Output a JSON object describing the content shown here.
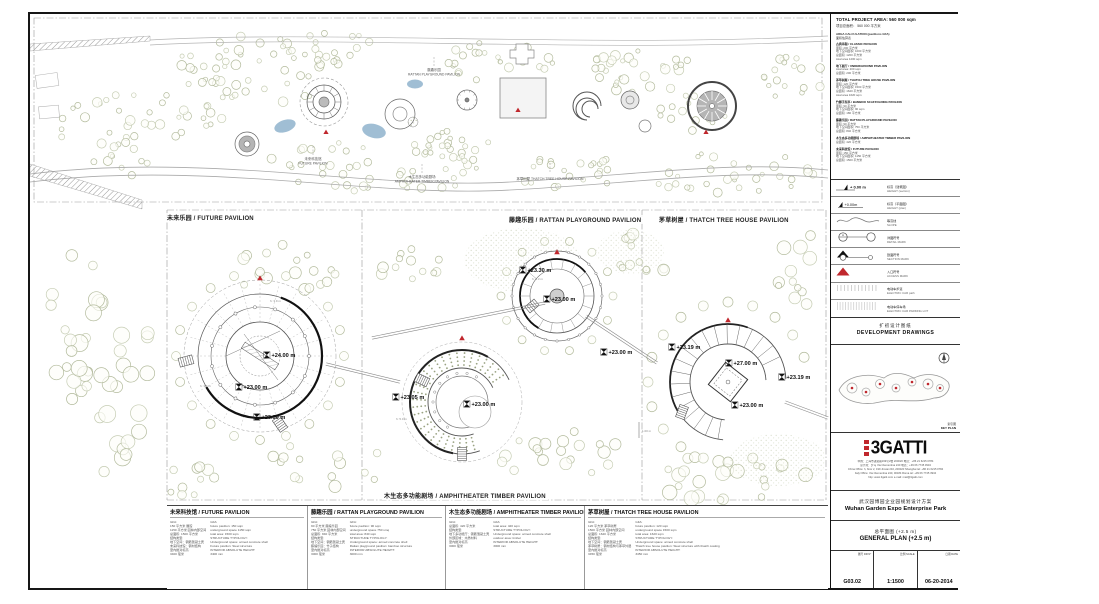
{
  "site_plan": {
    "labels": {
      "future": {
        "zh": "未来科技馆",
        "en": "FUTURE PAVILION"
      },
      "rattan": {
        "zh": "藤趣乐园",
        "en": "RATTAN PLAYGROUND PAVILION"
      },
      "amphitheater": {
        "zh": "木生态多功能剧场",
        "en": "AMPHITHEATER TIMBER PAVILION"
      },
      "thatch": {
        "zh": "茅草树屋",
        "en": "THATCH TREE HOUSE PAVILION"
      }
    }
  },
  "detail_panels": {
    "future": {
      "header": "未来乐园 / FUTURE PAVILION",
      "elevations": [
        "+24.00 m",
        "+23.00 m",
        "+23.00 m"
      ],
      "dims": [
        "h: 3.9 m",
        "h: 3.6 m"
      ]
    },
    "rattan": {
      "header": "藤趣乐园 / RATTAN PLAYGROUND PAVILION",
      "elevations": [
        "+23.05 m",
        "+23.00 m"
      ],
      "dims": [
        "h: 5.0 m"
      ]
    },
    "thatch": {
      "header": "茅草树屋 / THATCH TREE HOUSE PAVILION",
      "elevations": [
        "+23.19 m",
        "+27.00 m",
        "+23.19 m",
        "+23.00 m"
      ],
      "dims": [
        "1.00 m"
      ]
    },
    "amphitheater": {
      "header": "木生态多功能剧场 / AMPHITHEATER TIMBER PAVILION",
      "elevations": [
        "+23.30 m",
        "+23.00 m",
        "+23.00 m"
      ],
      "dims": [
        "h: 3.3 m"
      ]
    }
  },
  "gfa_blocks": [
    {
      "title": "未来科技馆 / FUTURE PAVILION",
      "col_zh": [
        "GFA:",
        "150 平方米 展馆",
        "1150 平方米 园林内部空间",
        "总面积: 1500 平方米",
        "结构类型:",
        "地下空间：钢筋混凝土壳",
        "未来科技馆：钢材结构",
        "室内绝对标高:",
        "3400 毫米"
      ],
      "col_en": [
        "GFA:",
        "future pavilion: 150 sqm",
        "underground space 1150 sqm",
        "total area: 1500 sqm",
        "STRUCTURE TYPOLOGY:",
        "Underground space: armed concrete shell",
        "Future pavilion: Steel structure",
        "INTERIOR ABSOLUTE HEIGHT:",
        "3400 mm"
      ]
    },
    {
      "title": "藤趣乐园 / RATTAN PLAYGROUND PAVILION",
      "col_zh": [
        "GFA:",
        "90 平方米 藤编乐园",
        "750 平方米 园林内部空间",
        "总面积: 840 平方米",
        "结构类型:",
        "地下空间：钢筋混凝土壳",
        "藤编乐园：竹子结构",
        "室内绝对标高:",
        "3000 毫米"
      ],
      "col_en": [
        "GFA:",
        "future pavilion: 90 sqm",
        "underground space 750 smq",
        "total area: 840 sqm",
        "STRUCTURE TYPOLOGY:",
        "Underground space: armed concrete shell",
        "Rattan playground pavilion: bamboo structure",
        "INTERIOR ABSOLUTE HEIGHT:",
        "3000 mm"
      ]
    },
    {
      "title": "木生态多功能剧场 / AMPHITHEATER TIMBER PAVILION",
      "col_zh": [
        "GFA:",
        "总面积: 420 平方米",
        "结构类型:",
        "地下多功能厅：钢筋混凝土壳",
        "外部区域：木质材料",
        "室内绝对标高:",
        "3000 毫米"
      ],
      "col_en": [
        "GFA:",
        "total area: 420 sqm",
        "STRUCTURE TYPOLOGY:",
        "Underground space: armed concrete shell",
        "outdoor area: timber",
        "INTERIOR ABSOLUTE HEIGHT:",
        "3000 mm"
      ]
    },
    {
      "title": "茅草树屋 / THATCH TREE HOUSE PAVILION",
      "col_zh": [
        "GFA:",
        "120 平方米 茅草树屋",
        "1500 平方米 园林内部空间",
        "总面积: 1620 平方米",
        "结构类型:",
        "地下空间：钢筋混凝土壳",
        "茅草树屋：钢材结构与茅草外层",
        "室内绝对标高:",
        "3450 毫米"
      ],
      "col_en": [
        "GFA:",
        "future pavilion: 120 sqm",
        "underground space 1500 sqm",
        "total area: 1620 sqm",
        "STRUCTURE TYPOLOGY:",
        "Underground space: armed concrete shell",
        "Thatch tree house pavilion: Steel structure with thatch coating",
        "INTERIOR ABSOLUTE HEIGHT:",
        "3450 mm"
      ]
    }
  ],
  "title_block": {
    "total_area_en": "TOTAL PROJECT AREA: 560 000 sqm",
    "total_area_zh": "项目总面积： 560 000 平方米",
    "area_calc_title_en": "AREA CALCULATION (pavilions GFA)",
    "area_calc_title_zh": "面积估算表",
    "area_entries": [
      [
        "古典亭阁 / CLASSIC PAVILION",
        "面积: 200 平方米",
        "地下空间面积: 1000 平方米",
        "总面积: 1200 平方米",
        "total area 1200 sqm"
      ],
      [
        "地下展厅 / UNDERGROUND PAVILION",
        "total area: 200 sqm",
        "总面积: 200 平方米"
      ],
      [
        "茅草树屋 / THATCH TREE HOUSE PAVILION",
        "面积: 120 平方米",
        "地下空间面积: 1500 平方米",
        "总面积: 1620 平方米",
        "total area 1620 sqm"
      ],
      [
        "竹脚手架亭 / BAMBOO SCAFFOLDING PAVILION",
        "面积: 90 平方米",
        "地下空间面积: 90 sqm",
        "总面积: 180 平方米"
      ],
      [
        "藤趣乐园 / RATTAN PLAYGROUND PAVILION",
        "面积: 90 平方米",
        "地下空间面积: 750 平方米",
        "总面积: 840 平方米"
      ],
      [
        "木生态多功能剧场 / AMPHITHEATER TIMBER PAVILION",
        "总面积: 420 平方米"
      ],
      [
        "未来科技馆 / FUTURE PAVILION",
        "面积: 150 平方米",
        "地下空间面积: 1150 平方米",
        "总面积: 1500 平方米"
      ]
    ],
    "legend": {
      "items": [
        {
          "symbol": "height-section",
          "symbol_text": "+ 0.00 m",
          "zh": "标高（建筑图）",
          "en": "HEIGHT (section)"
        },
        {
          "symbol": "height-plan",
          "symbol_text": "+0.00m",
          "zh": "标高（平面图）",
          "en": "HEIGHT (plan)"
        },
        {
          "symbol": "slope",
          "zh": "等高线",
          "en": "SLOPE"
        },
        {
          "symbol": "detail-mark",
          "zh": "详图符号",
          "en": "DETAIL MARK"
        },
        {
          "symbol": "section-mark",
          "zh": "剖面符号",
          "en": "SECTION MARK"
        },
        {
          "symbol": "access-mark",
          "zh": "入口符号",
          "en": "ACCESS MARK"
        },
        {
          "symbol": "electric-path",
          "zh": "电动车步道",
          "en": "ELECTRIC CAR path"
        },
        {
          "symbol": "electric-parking",
          "zh": "电动车停车场",
          "en": "ELECTRIC CAR PARKING LOT"
        }
      ]
    },
    "development_zh": "扩初设计图纸",
    "development_en": "DEVELOPMENT DRAWINGS",
    "keyplan_zh": "索引图",
    "keyplan_en": "KEY PLAN",
    "logo": "3GATTI",
    "address_lines": [
      "中国：上海市进贤路199号2楼 200020 电话：+86 21 6215 0784",
      "意大利：罗马 Via Clementina 240 电话：+39 06 7745 3934",
      "China Office: h, floor 2, 199 Jinxian Rd, 200020 Shanghai  tel: +86 21 6215 0784",
      "Italy Office: Via Clementina 240, 00184 Roma  tel: +39 06 7745 3934",
      "http: www.3gatti.com    e-mail: mail@3gatti.com"
    ],
    "project_zh": "武汉园博园企业园规划设计方案",
    "project_en": "Wuhan Garden Expo Enterprise Park",
    "drawing_zh": "总平面图  (+2.5 m)",
    "drawing_en": "GENERAL PLAN (+2.5 m)",
    "fields": [
      {
        "label": "图号 DR N°",
        "value": "G03.02"
      },
      {
        "label": "比例 SCALE",
        "value": "1:1500"
      },
      {
        "label": "日期 DATE",
        "value": "06-20-2014"
      }
    ]
  },
  "colors": {
    "accent_red": "#c0272d",
    "pond_blue": "#8fb3cc",
    "tree_green": "#b3bb9d",
    "line": "#444"
  }
}
